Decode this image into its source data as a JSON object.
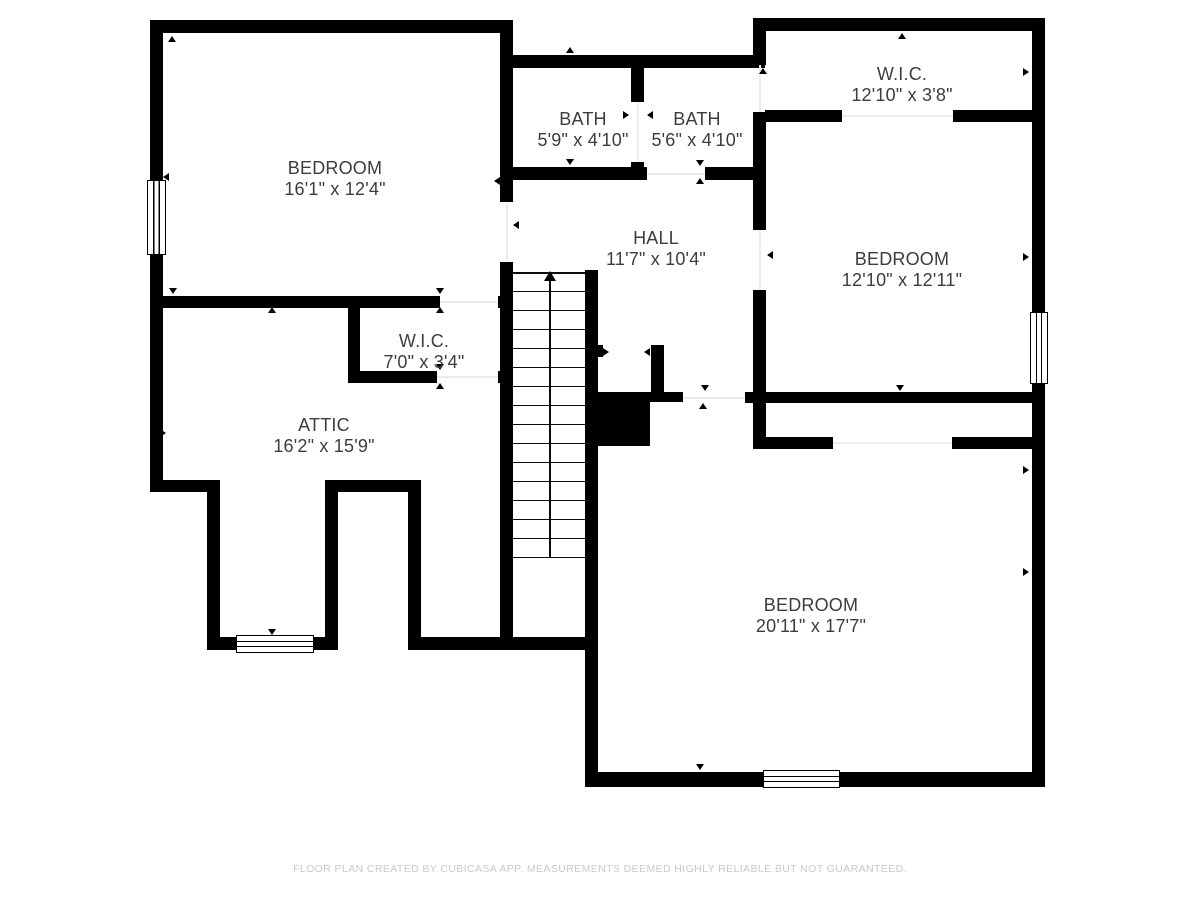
{
  "page": {
    "width": 1200,
    "height": 900,
    "background": "#ffffff"
  },
  "colors": {
    "wall": "#000000",
    "label": "#3d3d3d",
    "threshold": "#ececec",
    "footer": "#c9c9c9"
  },
  "footer": {
    "text": "FLOOR PLAN CREATED BY CUBICASA APP. MEASUREMENTS DEEMED HIGHLY RELIABLE BUT NOT GUARANTEED.",
    "y": 863
  },
  "rooms": [
    {
      "id": "bedroom-top-left",
      "name": "BEDROOM",
      "dims": "16'1\" x 12'4\"",
      "cx": 335,
      "cy": 179
    },
    {
      "id": "bath-left",
      "name": "BATH",
      "dims": "5'9\" x 4'10\"",
      "cx": 583,
      "cy": 130
    },
    {
      "id": "bath-right",
      "name": "BATH",
      "dims": "5'6\" x 4'10\"",
      "cx": 697,
      "cy": 130
    },
    {
      "id": "wic-top-right",
      "name": "W.I.C.",
      "dims": "12'10\" x 3'8\"",
      "cx": 902,
      "cy": 85
    },
    {
      "id": "bedroom-right",
      "name": "BEDROOM",
      "dims": "12'10\" x 12'11\"",
      "cx": 902,
      "cy": 270
    },
    {
      "id": "hall",
      "name": "HALL",
      "dims": "11'7\" x 10'4\"",
      "cx": 656,
      "cy": 249
    },
    {
      "id": "wic-middle",
      "name": "W.I.C.",
      "dims": "7'0\" x 3'4\"",
      "cx": 424,
      "cy": 352
    },
    {
      "id": "attic",
      "name": "ATTIC",
      "dims": "16'2\" x 15'9\"",
      "cx": 324,
      "cy": 436
    },
    {
      "id": "bedroom-bottom",
      "name": "BEDROOM",
      "dims": "20'11\" x 17'7\"",
      "cx": 811,
      "cy": 616
    }
  ],
  "walls": [
    [
      150,
      20,
      363,
      13
    ],
    [
      150,
      20,
      13,
      472
    ],
    [
      150,
      296,
      290,
      12
    ],
    [
      498,
      296,
      15,
      12
    ],
    [
      500,
      20,
      13,
      182
    ],
    [
      500,
      262,
      13,
      375
    ],
    [
      150,
      480,
      68,
      12
    ],
    [
      207,
      480,
      13,
      170
    ],
    [
      207,
      637,
      131,
      13
    ],
    [
      325,
      492,
      13,
      158
    ],
    [
      325,
      480,
      96,
      12
    ],
    [
      408,
      480,
      13,
      170
    ],
    [
      408,
      637,
      182,
      13
    ],
    [
      348,
      296,
      12,
      87
    ],
    [
      348,
      371,
      89,
      12
    ],
    [
      498,
      371,
      15,
      12
    ],
    [
      505,
      55,
      260,
      13
    ],
    [
      631,
      55,
      13,
      47
    ],
    [
      631,
      162,
      13,
      18
    ],
    [
      500,
      167,
      147,
      13
    ],
    [
      705,
      167,
      60,
      13
    ],
    [
      765,
      18,
      280,
      13
    ],
    [
      753,
      18,
      13,
      47
    ],
    [
      753,
      112,
      13,
      118
    ],
    [
      753,
      290,
      13,
      159
    ],
    [
      765,
      110,
      77,
      12
    ],
    [
      953,
      110,
      92,
      12
    ],
    [
      1032,
      18,
      13,
      769
    ],
    [
      745,
      392,
      300,
      11
    ],
    [
      595,
      392,
      88,
      10
    ],
    [
      753,
      437,
      80,
      12
    ],
    [
      952,
      437,
      93,
      12
    ],
    [
      585,
      270,
      13,
      517
    ],
    [
      585,
      772,
      460,
      15
    ],
    [
      595,
      392,
      55,
      54
    ],
    [
      651,
      345,
      13,
      52
    ],
    [
      597,
      345,
      6,
      12
    ]
  ],
  "windows": [
    {
      "name": "window-bedroom-top-left",
      "rect": [
        147,
        180,
        19,
        75
      ]
    },
    {
      "name": "window-bedroom-right",
      "rect": [
        1030,
        312,
        18,
        72
      ]
    },
    {
      "name": "window-attic-bay",
      "rect": [
        236,
        635,
        78,
        18
      ]
    },
    {
      "name": "window-bedroom-bottom",
      "rect": [
        763,
        770,
        77,
        18
      ]
    }
  ],
  "thresholds": [
    [
      506,
      202,
      2,
      60
    ],
    [
      440,
      301,
      58,
      2
    ],
    [
      437,
      376,
      61,
      2
    ],
    [
      637,
      102,
      2,
      60
    ],
    [
      647,
      173,
      58,
      2
    ],
    [
      759,
      65,
      2,
      47
    ],
    [
      759,
      230,
      2,
      60
    ],
    [
      842,
      115,
      111,
      2
    ],
    [
      683,
      397,
      62,
      2
    ],
    [
      833,
      442,
      119,
      2
    ]
  ],
  "door_markers": [
    [
      172,
      39,
      "up"
    ],
    [
      166,
      177,
      "left"
    ],
    [
      173,
      291,
      "down"
    ],
    [
      272,
      310,
      "up"
    ],
    [
      440,
      291,
      "down"
    ],
    [
      440,
      310,
      "up"
    ],
    [
      440,
      367,
      "down"
    ],
    [
      440,
      386,
      "up"
    ],
    [
      497,
      181,
      "left"
    ],
    [
      516,
      225,
      "left"
    ],
    [
      570,
      50,
      "up"
    ],
    [
      570,
      162,
      "down"
    ],
    [
      626,
      115,
      "right"
    ],
    [
      650,
      115,
      "left"
    ],
    [
      700,
      163,
      "down"
    ],
    [
      700,
      181,
      "up"
    ],
    [
      763,
      71,
      "up"
    ],
    [
      902,
      36,
      "up"
    ],
    [
      1026,
      72,
      "right"
    ],
    [
      770,
      255,
      "left"
    ],
    [
      1026,
      257,
      "right"
    ],
    [
      900,
      388,
      "down"
    ],
    [
      705,
      388,
      "down"
    ],
    [
      703,
      406,
      "up"
    ],
    [
      606,
      352,
      "right"
    ],
    [
      647,
      352,
      "left"
    ],
    [
      163,
      433,
      "right"
    ],
    [
      1026,
      470,
      "right"
    ],
    [
      1026,
      572,
      "right"
    ],
    [
      272,
      632,
      "down"
    ],
    [
      700,
      767,
      "down"
    ]
  ],
  "stairs": {
    "x": 513,
    "y": 272,
    "w": 72,
    "h": 286,
    "tread_count": 15,
    "center_x": 549,
    "direction": "up"
  }
}
